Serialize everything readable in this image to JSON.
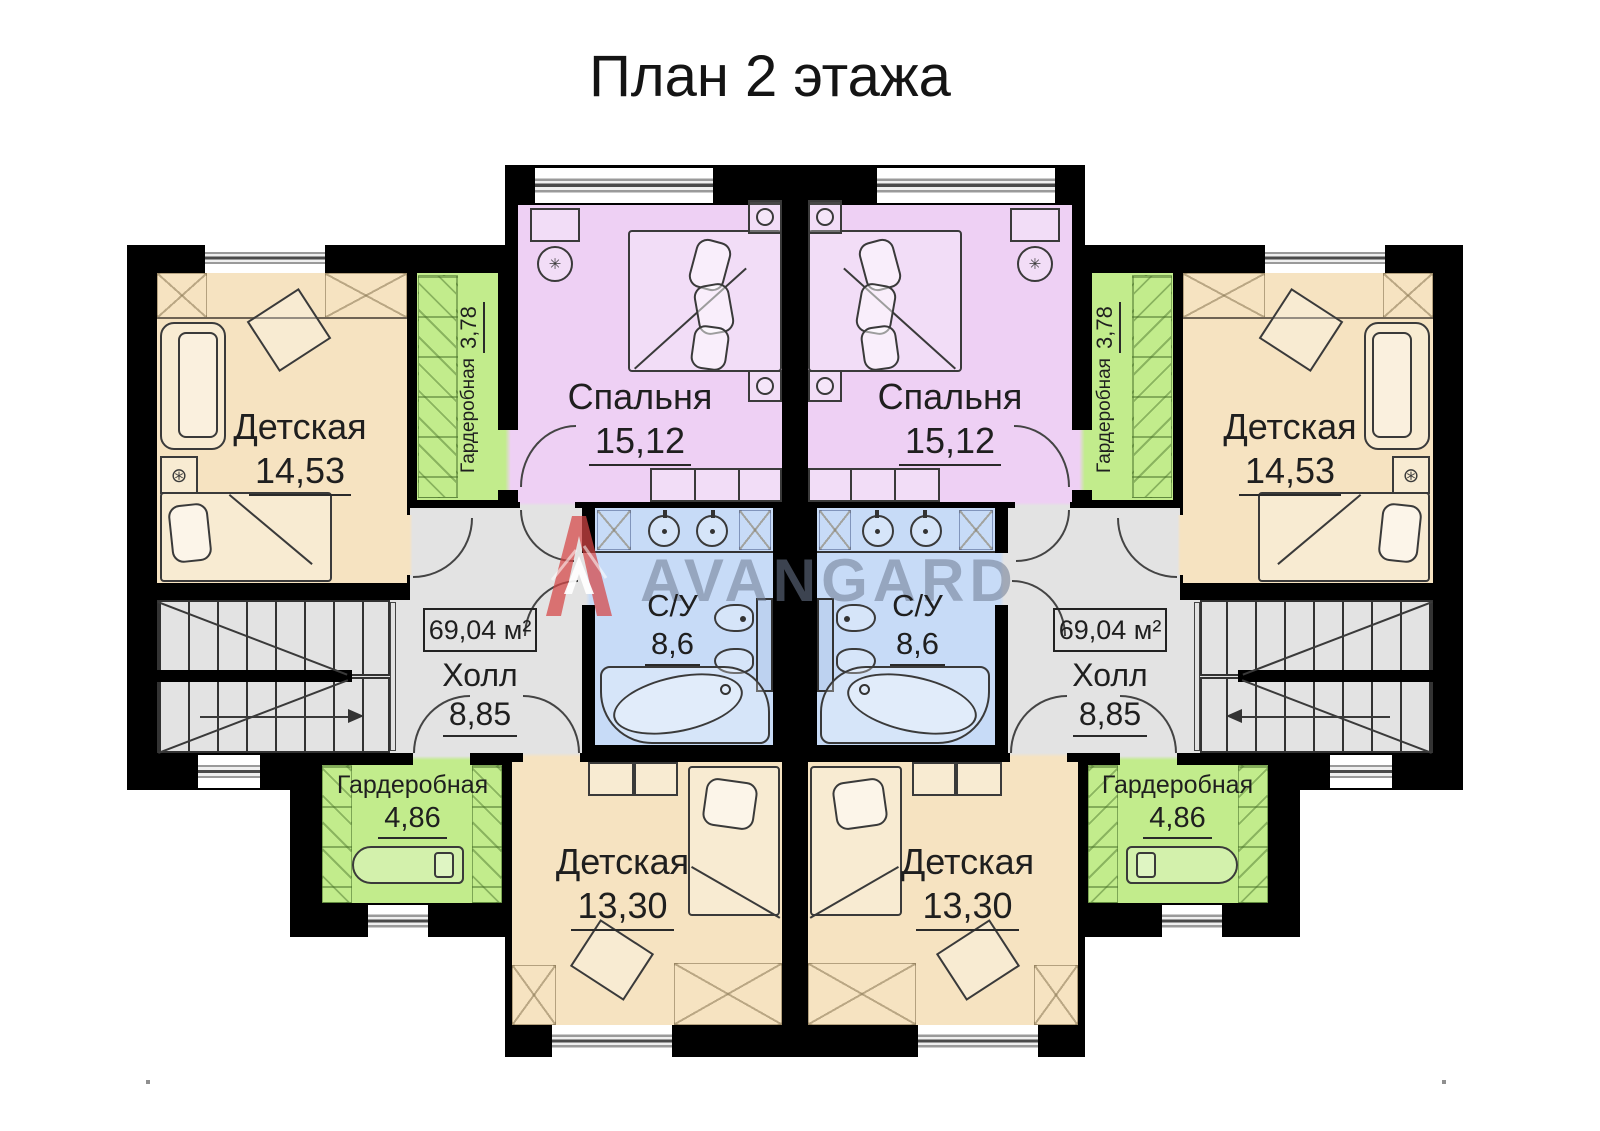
{
  "title": "План 2 этажа",
  "watermark": {
    "brand": "AVANGARD",
    "logo": "avangard-a-logo"
  },
  "total_area": {
    "label": "69,04 м²"
  },
  "rooms": {
    "nursery_top": {
      "name": "Детская",
      "area": "14,53"
    },
    "wardrobe_top": {
      "name": "Гардеробная",
      "area": "3,78"
    },
    "bedroom": {
      "name": "Спальня",
      "area": "15,12"
    },
    "bathroom": {
      "name": "С/У",
      "area": "8,6"
    },
    "hall": {
      "name": "Холл",
      "area": "8,85"
    },
    "wardrobe_bottom": {
      "name": "Гардеробная",
      "area": "4,86"
    },
    "nursery_bottom": {
      "name": "Детская",
      "area": "13,30"
    }
  },
  "colors": {
    "wall": "#000000",
    "nursery": "#f6e3c1",
    "wardrobe": "#c2ec8c",
    "bedroom": "#eed0f4",
    "bathroom": "#c7dbf7",
    "hall": "#e3e3e3",
    "watermark_text": "#6e7a91",
    "watermark_logo": "#d64545"
  }
}
